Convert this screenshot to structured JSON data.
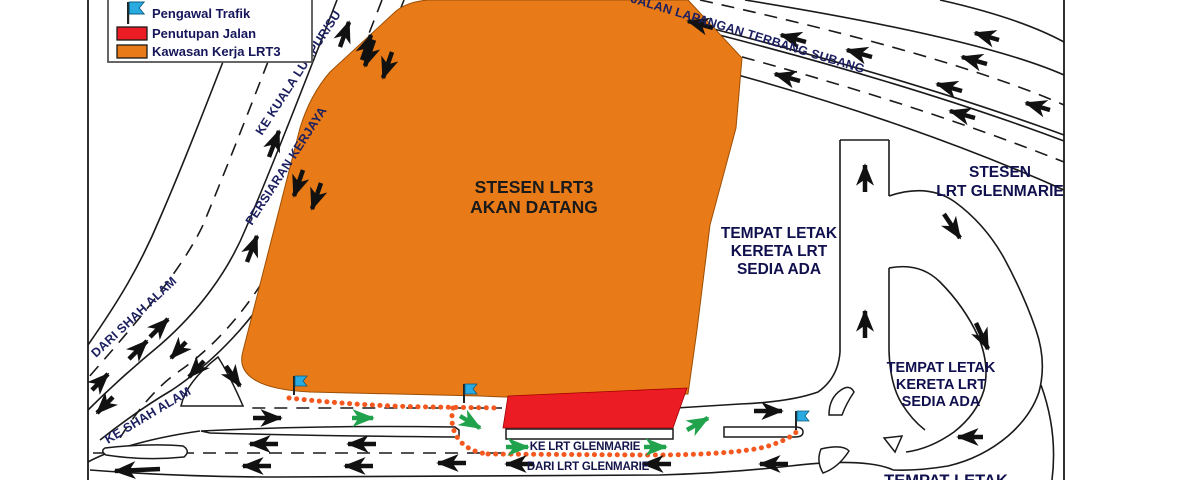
{
  "title": "LRT3 traffic management plan – Glenmarie",
  "legend": {
    "items": [
      {
        "icon": "flag-icon",
        "label": "Pengawal Trafik"
      },
      {
        "icon": "closure-swatch",
        "label": "Penutupan Jalan"
      },
      {
        "icon": "work-area-swatch",
        "label": "Kawasan Kerja LRT3"
      }
    ]
  },
  "labels": {
    "ke_kuala_lumpur": "KE KUALA LUMPUR/SU",
    "persiaran_kerjaya": "PERSIARAN KERJAYA",
    "dari_shah_alam": "DARI SHAH ALAM",
    "ke_shah_alam": "KE SHAH ALAM",
    "jalan_lapangan": "JALAN LAPANGAN TERBANG SUBANG",
    "stesen_lrt3_line1": "STESEN LRT3",
    "stesen_lrt3_line2": "AKAN DATANG",
    "tempat1_line1": "TEMPAT LETAK",
    "tempat1_line2": "KERETA LRT",
    "tempat1_line3": "SEDIA ADA",
    "stesen_glenmarie_line1": "STESEN",
    "stesen_glenmarie_line2": "LRT GLENMARIE",
    "tempat2_line1": "TEMPAT LETAK",
    "tempat2_line2": "KERETA LRT",
    "tempat2_line3": "SEDIA ADA",
    "ke_lrt_glenmarie": "KE LRT GLENMARIE",
    "dari_lrt_glenmarie": "DARI LRT GLENMARIE",
    "tempat3": "TEMPAT LETAK"
  },
  "colors": {
    "work_area": "#E87B17",
    "closure": "#EC1C24",
    "flag": "#29ABE2",
    "diversion_dots": "#F4581F",
    "diversion_arrow": "#21A24C",
    "road_line": "#1a1a1a"
  }
}
